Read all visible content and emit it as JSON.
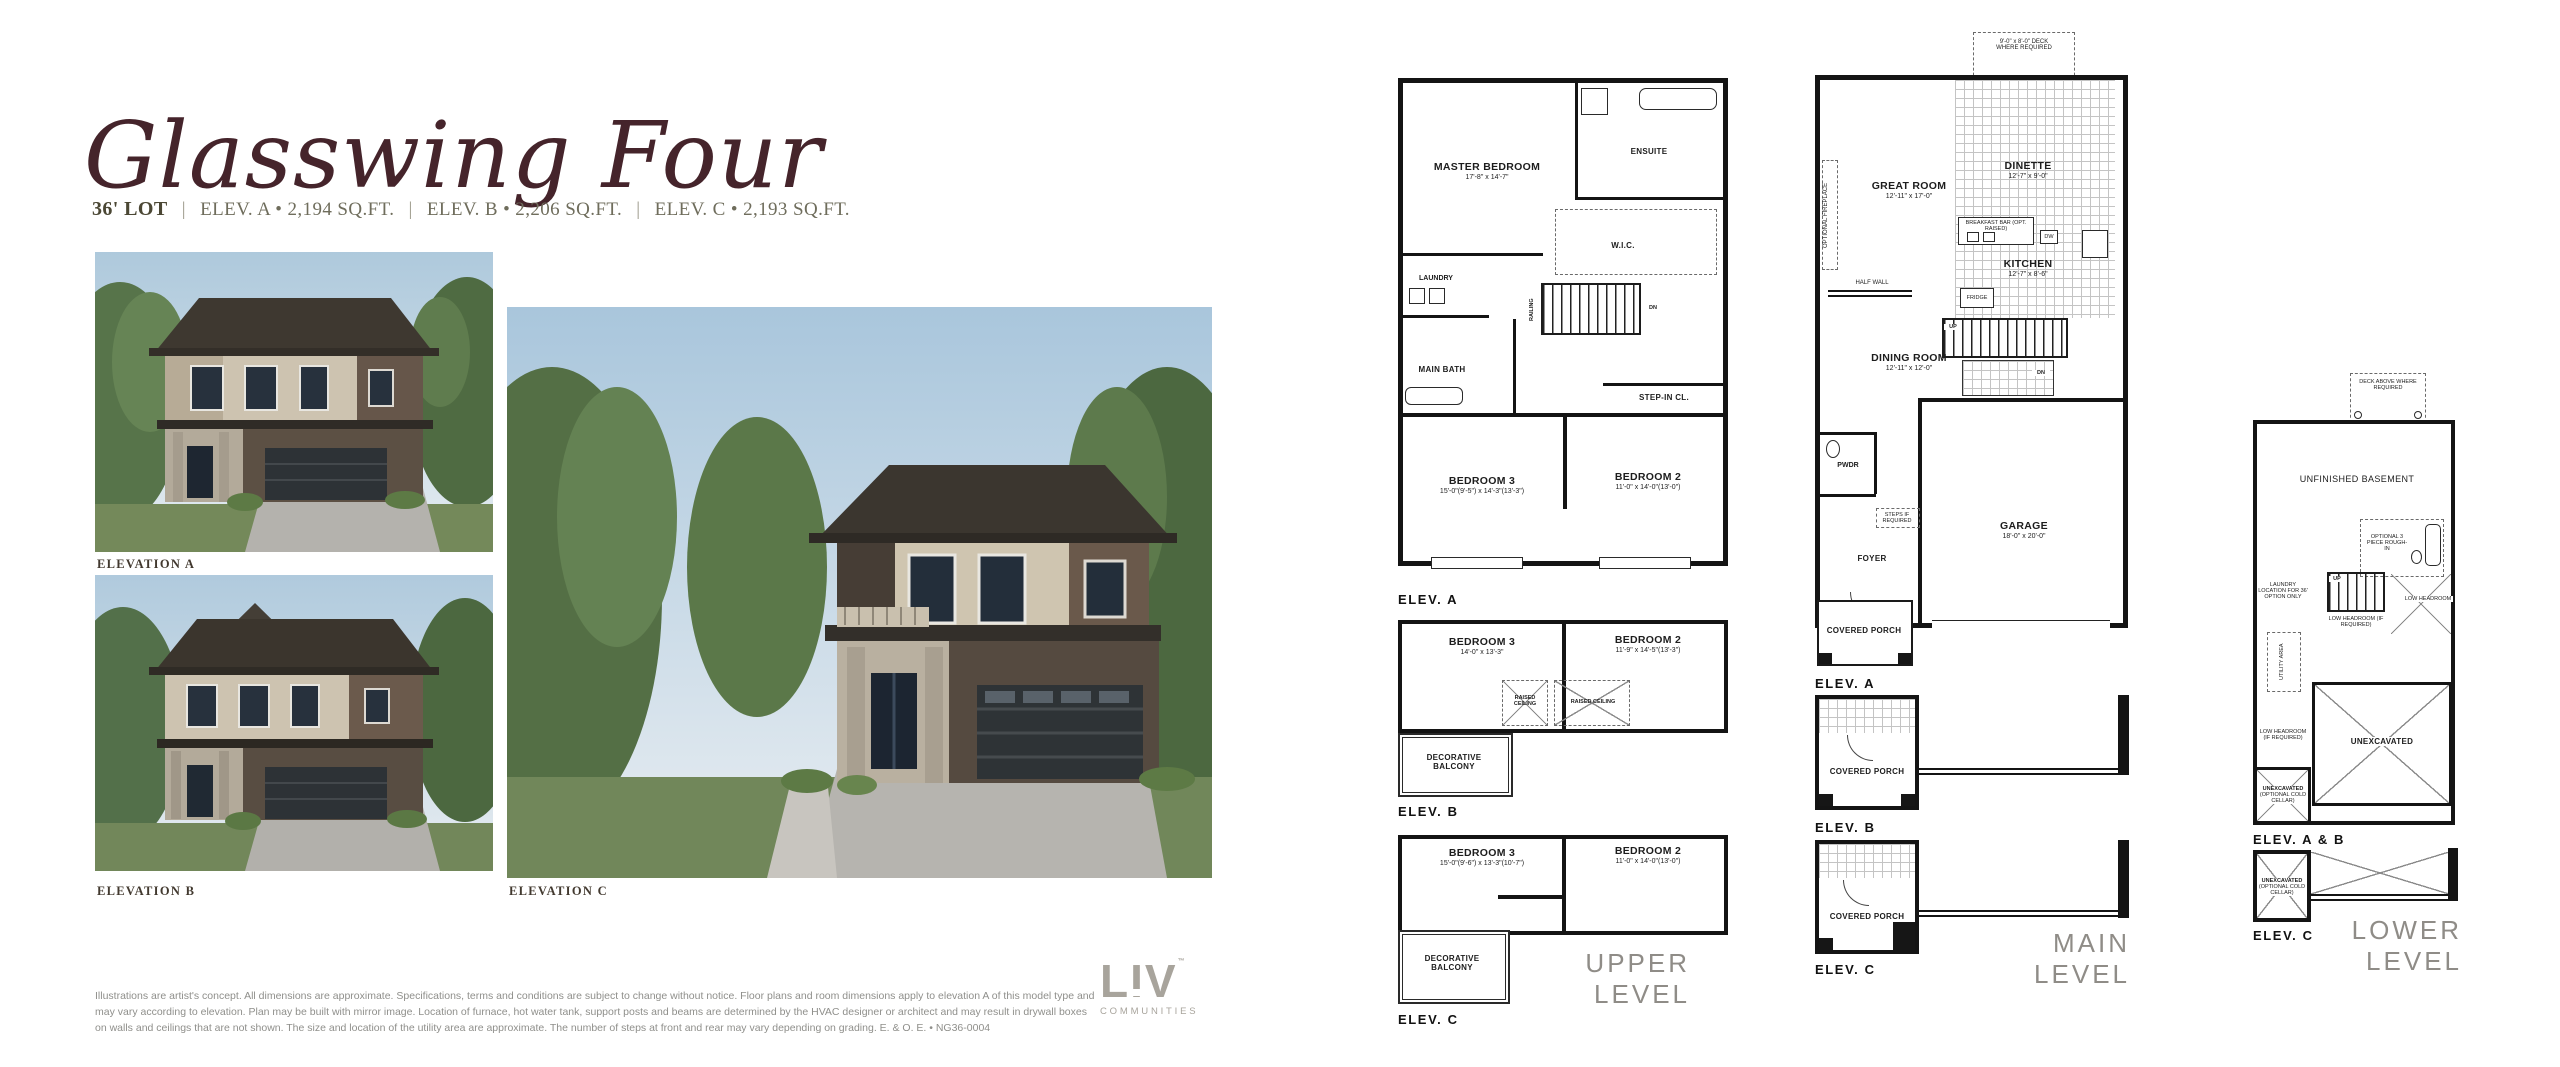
{
  "title": "Glasswing Four",
  "subtitle": {
    "lot": "36' LOT",
    "separator": "|",
    "elev_a": "ELEV. A • 2,194 SQ.FT.",
    "elev_b": "ELEV. B • 2,206 SQ.FT.",
    "elev_c": "ELEV. C • 2,193 SQ.FT."
  },
  "renderings": {
    "a_label": "ELEVATION A",
    "b_label": "ELEVATION B",
    "c_label": "ELEVATION C"
  },
  "upper_level": {
    "heading": "UPPER LEVEL",
    "elev_a": {
      "tag": "ELEV. A",
      "master_name": "MASTER BEDROOM",
      "master_dims": "17'-8\" x 14'-7\"",
      "ensuite": "ENSUITE",
      "wic": "W.I.C.",
      "laundry": "LAUNDRY",
      "main_bath": "MAIN BATH",
      "step_in_closet": "STEP-IN CL.",
      "railing": "RAILING",
      "dn": "DN",
      "bedroom3_name": "BEDROOM 3",
      "bedroom3_dims": "15'-0\"(9'-5\") x 14'-3\"(13'-3\")",
      "bedroom2_name": "BEDROOM 2",
      "bedroom2_dims": "11'-0\" x 14'-0\"(13'-0\")"
    },
    "elev_b": {
      "tag": "ELEV. B",
      "bedroom3_name": "BEDROOM 3",
      "bedroom3_dims": "14'-0\" x 13'-3\"",
      "bedroom2_name": "BEDROOM 2",
      "bedroom2_dims": "11'-9\" x 14'-5\"(13'-3\")",
      "raised_ceiling": "RAISED CEILING",
      "balcony": "DECORATIVE BALCONY"
    },
    "elev_c": {
      "tag": "ELEV. C",
      "bedroom3_name": "BEDROOM 3",
      "bedroom3_dims": "15'-0\"(9'-6\") x 13'-3\"(10'-7\")",
      "bedroom2_name": "BEDROOM 2",
      "bedroom2_dims": "11'-0\" x 14'-0\"(13'-0\")",
      "balcony": "DECORATIVE BALCONY"
    }
  },
  "main_level": {
    "heading": "MAIN LEVEL",
    "elev_a": {
      "tag": "ELEV. A",
      "deck_note": "9'-0\" x 8'-0\" DECK WHERE REQUIRED",
      "great_room_name": "GREAT ROOM",
      "great_room_dims": "12'-11\" x 17'-0\"",
      "optional_fireplace": "OPTIONAL FIREPLACE",
      "dinette_name": "DINETTE",
      "dinette_dims": "12'-7\" x 9'-0\"",
      "kitchen_name": "KITCHEN",
      "kitchen_dims": "12'-7\" x 8'-6\"",
      "breakfast_bar": "BREAKFAST BAR (OPT. RAISED)",
      "dw": "DW",
      "fridge": "FRIDGE",
      "half_wall": "HALF WALL",
      "up": "UP",
      "dn": "DN",
      "dining_name": "DINING ROOM",
      "dining_dims": "12'-11\" x 12'-0\"",
      "pwdr": "PWDR",
      "steps_note": "STEPS IF REQUIRED",
      "foyer": "FOYER",
      "garage_name": "GARAGE",
      "garage_dims": "18'-0\" x 20'-0\"",
      "porch": "COVERED PORCH"
    },
    "elev_b": {
      "tag": "ELEV. B",
      "porch": "COVERED PORCH"
    },
    "elev_c": {
      "tag": "ELEV. C",
      "porch": "COVERED PORCH"
    }
  },
  "lower_level": {
    "heading": "LOWER LEVEL",
    "elev_ab": {
      "tag": "ELEV. A & B",
      "deck_note": "DECK ABOVE WHERE REQUIRED",
      "basement": "UNFINISHED BASEMENT",
      "rough_in": "OPTIONAL 3 PIECE ROUGH-IN",
      "laundry_note": "LAUNDRY LOCATION FOR 36' OPTION ONLY",
      "up": "UP",
      "low_headroom_small": "LOW HEADROOM",
      "low_headroom_req": "LOW HEADROOM (IF REQUIRED)",
      "utility": "UTILITY AREA",
      "unexcavated": "UNEXCAVATED",
      "cold_cellar_line1": "UNEXCAVATED",
      "cold_cellar_line2": "(OPTIONAL COLD CELLAR)"
    },
    "elev_c": {
      "tag": "ELEV. C",
      "unexcavated": "UNEXCAVATED",
      "cold_cellar": "(OPTIONAL COLD CELLAR)"
    }
  },
  "footer": {
    "disclaimer": "Illustrations are artist's concept. All dimensions are approximate. Specifications, terms and conditions are subject to change without notice. Floor plans and room dimensions apply to elevation A of this model type and may vary according to elevation. Plan may be built with mirror image. Location of furnace, hot water tank, support posts and beams are determined by the HVAC designer or architect and may result in drywall boxes on walls and ceilings that are not shown. The size and location of the utility area are approximate. The number of steps at front and rear may vary depending on grading. E. & O. E. • NG36-0004",
    "logo_name": "LIV",
    "logo_tm": "™",
    "logo_tagline": "COMMUNITIES"
  },
  "colors": {
    "title": "#45242b",
    "subtitle": "#6f6d5c",
    "logo_gray": "#a8a49c",
    "level_heading_gray": "#8f8c87",
    "plan_line": "#141414"
  }
}
